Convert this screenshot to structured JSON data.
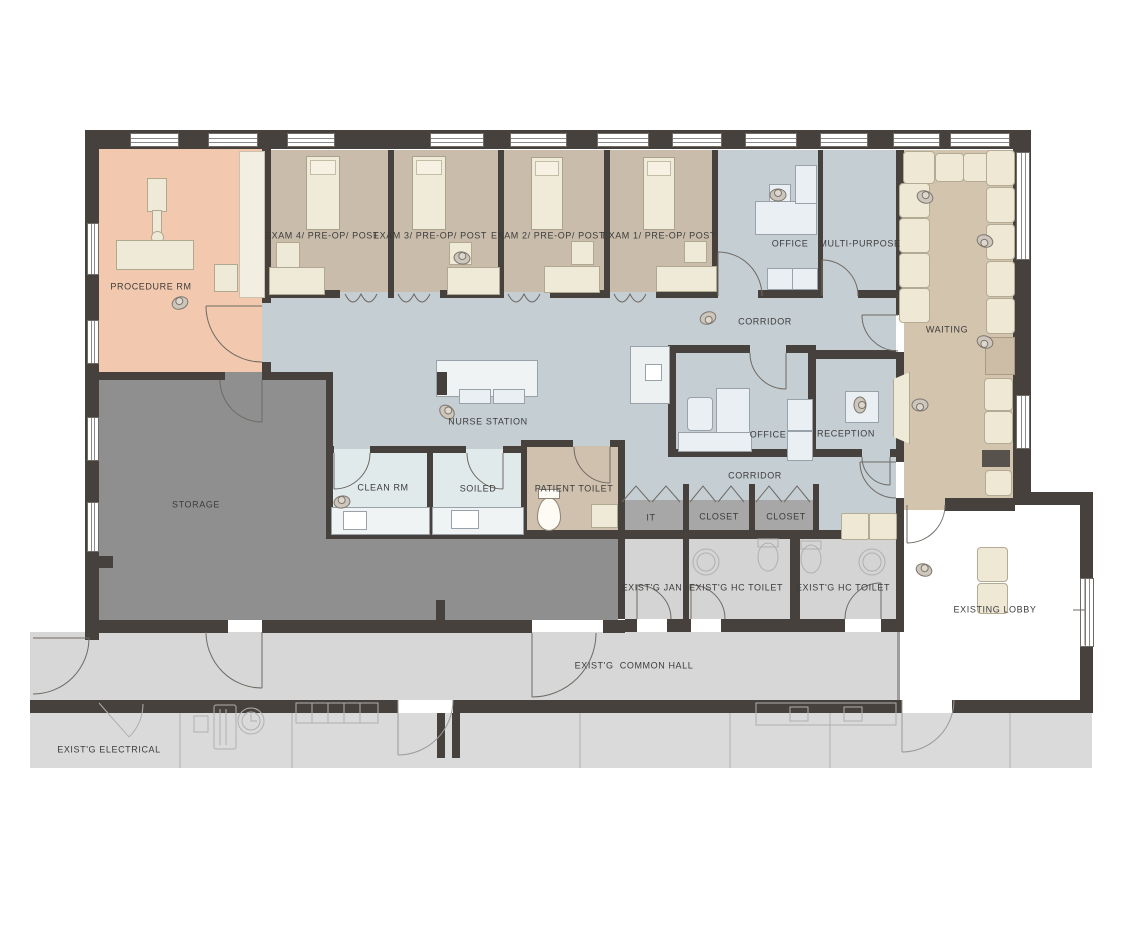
{
  "plan": {
    "title": "Surgery clinic floor plan",
    "rooms": [
      {
        "label": "PROCEDURE RM"
      },
      {
        "label": "EXAM 4/ PRE-OP/ POST"
      },
      {
        "label": "EXAM 3/ PRE-OP/ POST"
      },
      {
        "label": "EXAM 2/ PRE-OP/ POST"
      },
      {
        "label": "EXAM 1/ PRE-OP/ POST"
      },
      {
        "label": "OFFICE"
      },
      {
        "label": "MULTI-PURPOSE"
      },
      {
        "label": "WAITING"
      },
      {
        "label": "CORRIDOR"
      },
      {
        "label": "NURSE STATION"
      },
      {
        "label": "OFFICE"
      },
      {
        "label": "RECEPTION"
      },
      {
        "label": "CORRIDOR"
      },
      {
        "label": "CLEAN RM"
      },
      {
        "label": "SOILED"
      },
      {
        "label": "PATIENT TOILET"
      },
      {
        "label": "IT"
      },
      {
        "label": "CLOSET"
      },
      {
        "label": "CLOSET"
      },
      {
        "label": "STORAGE"
      },
      {
        "label": "EXIST'G JAN"
      },
      {
        "label": "EXIST'G HC TOILET"
      },
      {
        "label": "EXIST'G HC TOILET"
      },
      {
        "label": "EXISTING LOBBY"
      },
      {
        "label": "EXIST'G  COMMON HALL"
      },
      {
        "label": "EXIST'G ELECTRICAL"
      }
    ],
    "colors": {
      "wall": "#46413d",
      "procedure_room": "#f2c9ae",
      "exam_room": "#c9bcaa",
      "clinical_corridor": "#c5ced3",
      "clean_utility": "#e1eaea",
      "patient_toilet": "#cfc1ad",
      "waiting": "#d3c4ae",
      "storage": "#8f8f8f",
      "closet": "#a7a7a7",
      "existing_room": "#d4d4d4",
      "common_hall": "#d7d7d7",
      "lobby": "#ffffff",
      "furniture_cream": "#efe9d7",
      "furniture_blue": "#e9eff2"
    },
    "icons": {
      "person_figures": 12
    }
  }
}
